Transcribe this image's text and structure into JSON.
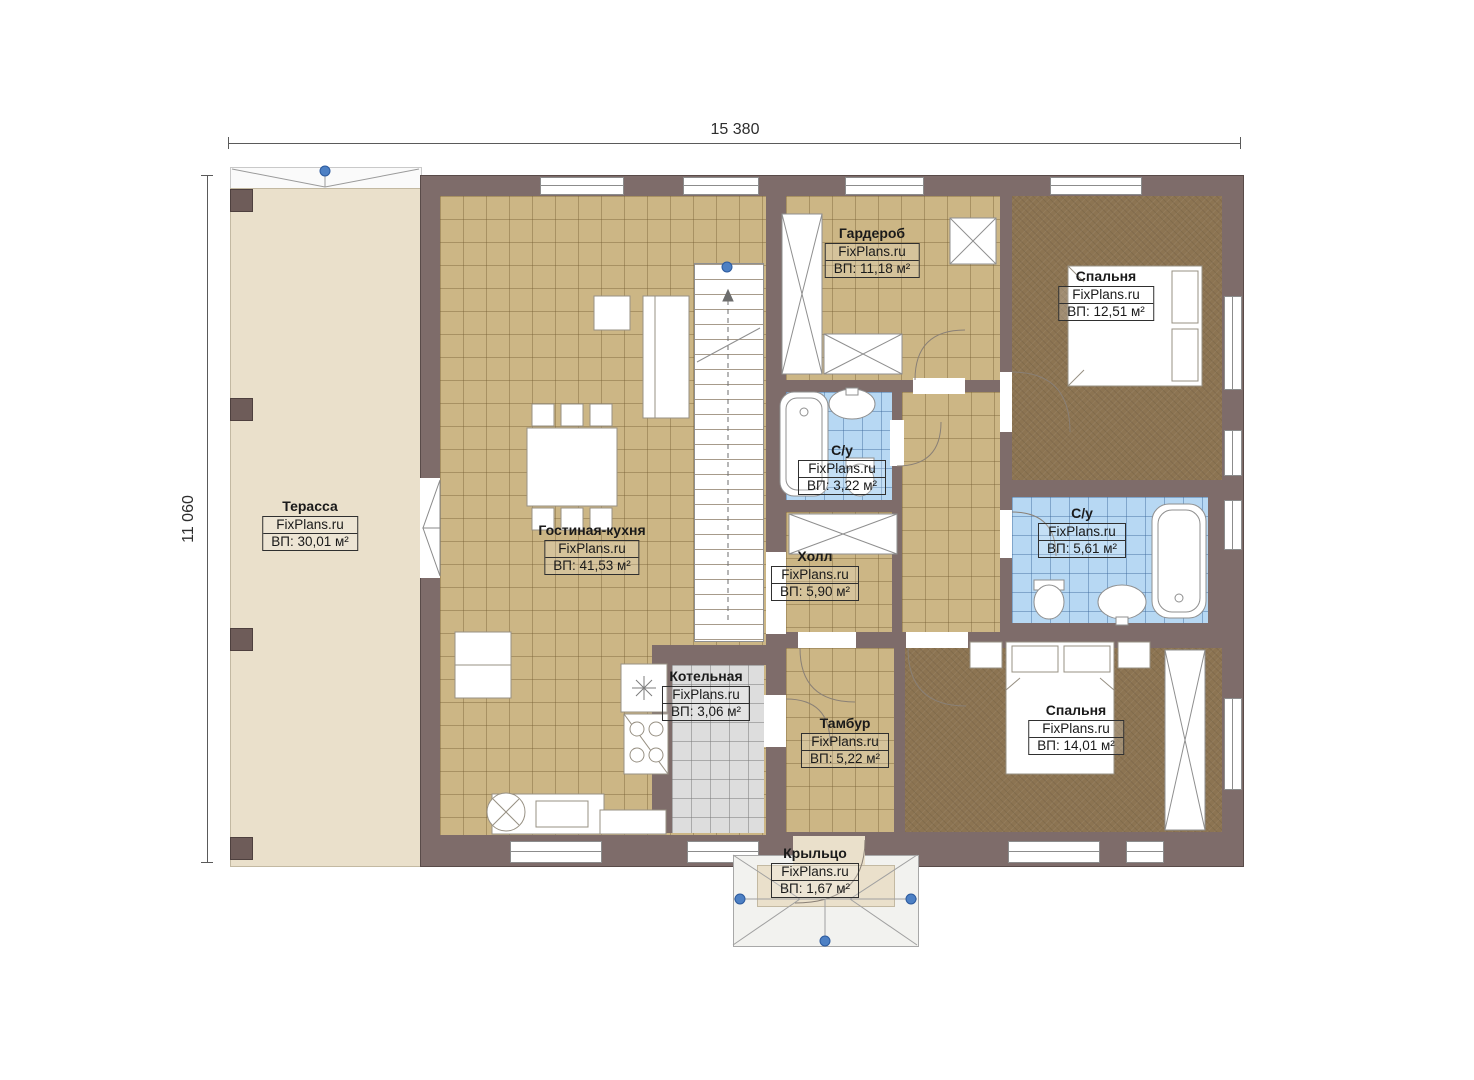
{
  "brand": "FixPlans.ru",
  "dimensions": {
    "top": "15 380",
    "left": "11 060"
  },
  "rooms": [
    {
      "name": "Терасса",
      "area_text": "ВП: 30,01 м²"
    },
    {
      "name": "Гостиная-кухня",
      "area_text": "ВП: 41,53 м²"
    },
    {
      "name": "Гардероб",
      "area_text": "ВП: 11,18 м²"
    },
    {
      "name": "Спальня",
      "area_text": "ВП: 12,51 м²"
    },
    {
      "name": "С/у",
      "area_text": "ВП: 3,22 м²"
    },
    {
      "name": "С/у",
      "area_text": "ВП: 5,61 м²"
    },
    {
      "name": "Холл",
      "area_text": "ВП: 5,90 м²"
    },
    {
      "name": "Котельная",
      "area_text": "ВП: 3,06 м²"
    },
    {
      "name": "Тамбур",
      "area_text": "ВП: 5,22 м²"
    },
    {
      "name": "Спальня",
      "area_text": "ВП: 14,01 м²"
    },
    {
      "name": "Крыльцо",
      "area_text": "ВП: 1,67 м²"
    }
  ],
  "colors": {
    "wall": "#7e6c6a",
    "floor_tile_tan": "#ccb685",
    "floor_bath_blue": "#b7d8f3",
    "floor_boiler_gray": "#dddddd",
    "floor_bedroom_brown": "#8c7452",
    "terrace_beige": "#eae0cb",
    "marker_blue": "#4d80c4"
  }
}
